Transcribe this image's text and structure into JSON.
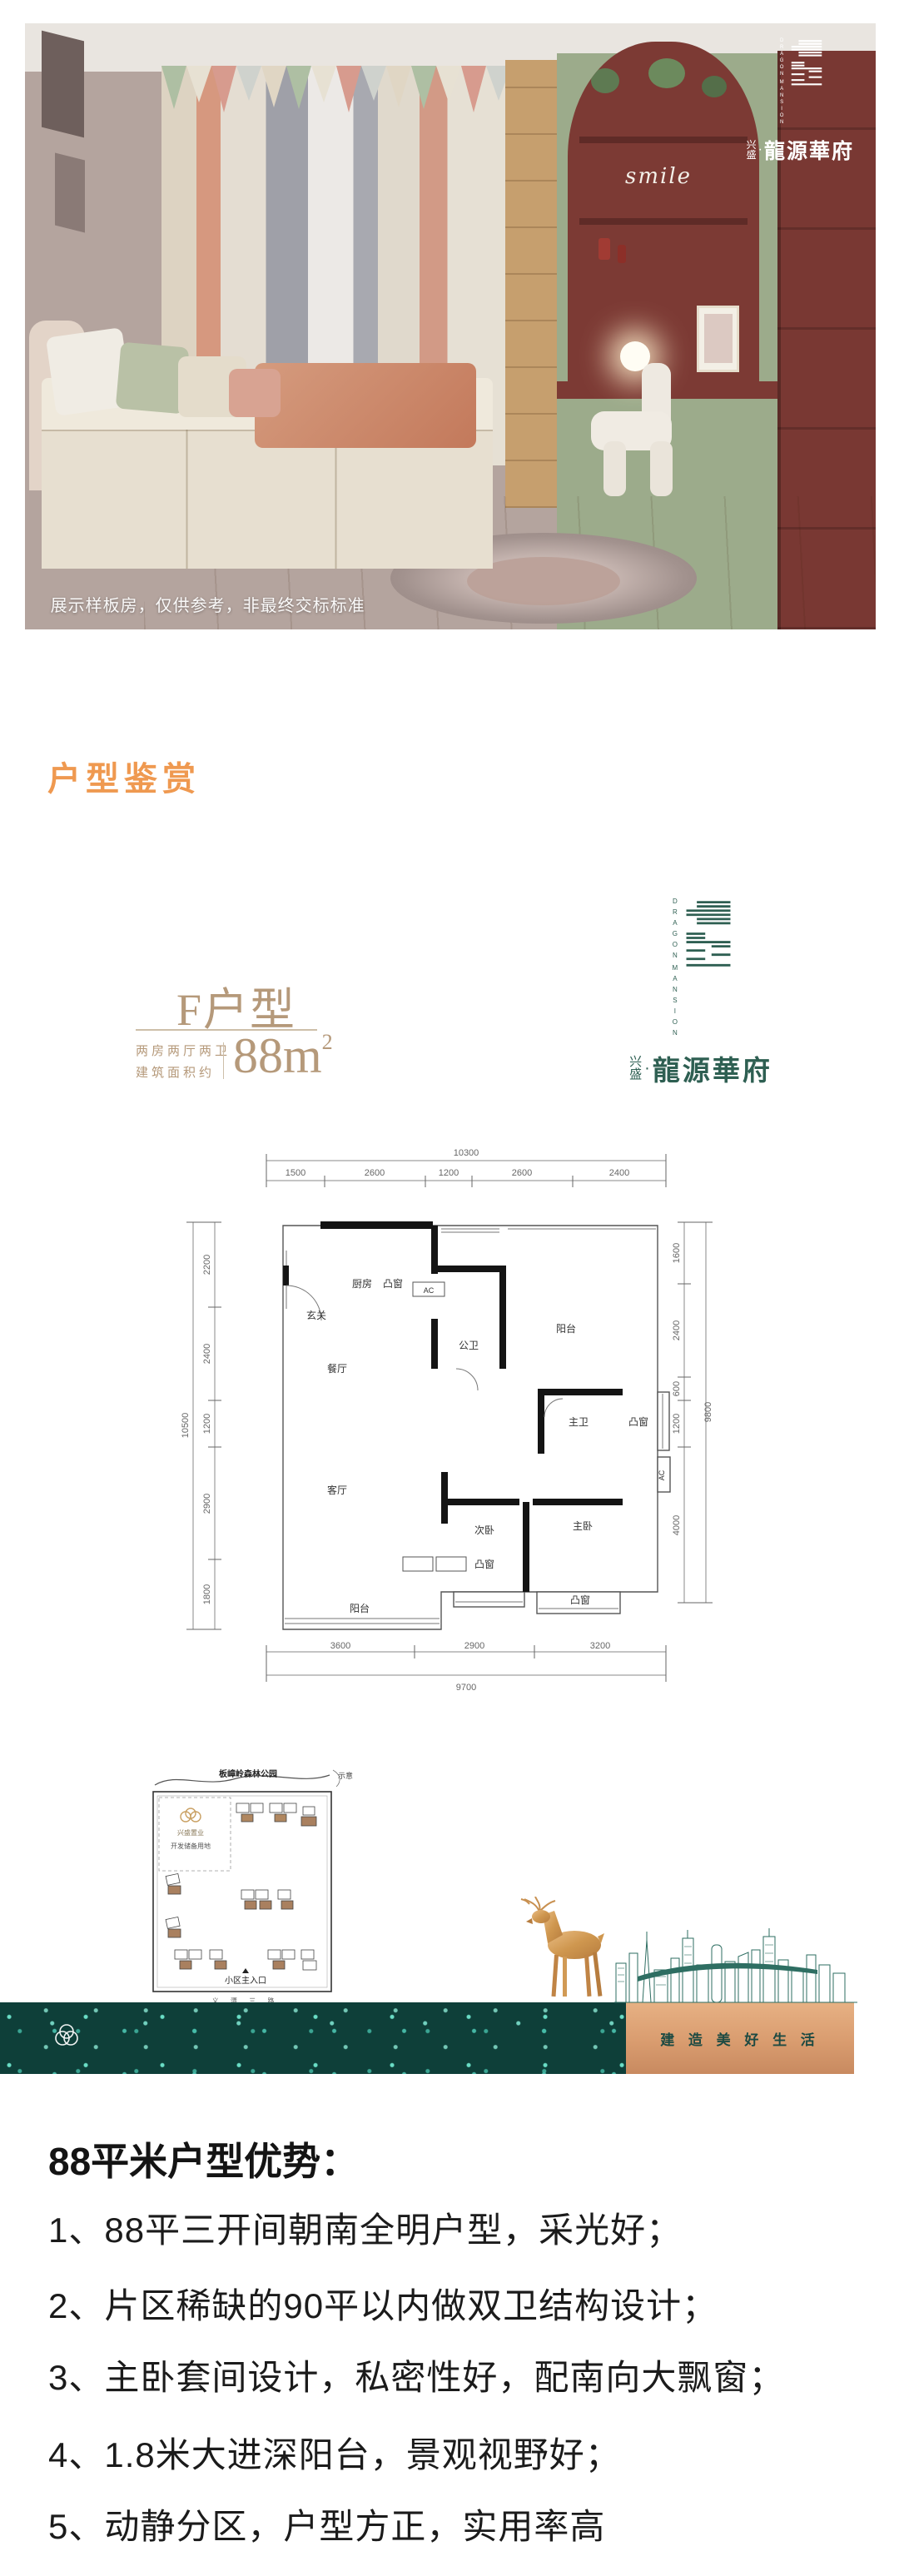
{
  "hero": {
    "watermark": "展示样板房，仅供参考，非最终交标标准",
    "shelf_text": "smile"
  },
  "brand": {
    "en_word1": "DRAGON",
    "en_word2": "MANSION",
    "prefix_char1": "兴",
    "prefix_char2": "盛",
    "dot": "·",
    "name": "龍源華府"
  },
  "section": {
    "title": "户型鉴赏"
  },
  "plan_header": {
    "type_name": "F户型",
    "spec_line1": "两房两厅两卫",
    "spec_line2": "建筑面积约",
    "area_value": "88m",
    "area_sup": "2"
  },
  "floorplan": {
    "dims_top": {
      "total": "10300",
      "segments": [
        "1500",
        "2600",
        "1200",
        "2600",
        "2400"
      ]
    },
    "dims_bottom": {
      "total": "9700",
      "segments": [
        "3600",
        "2900",
        "3200"
      ]
    },
    "dims_left": {
      "total": "10500",
      "segments": [
        "2200",
        "2400",
        "1200",
        "2900",
        "1800"
      ]
    },
    "dims_right": {
      "total": "9800",
      "segments": [
        "1600",
        "2400",
        "600",
        "1200",
        "4000"
      ]
    },
    "rooms": {
      "entry": "玄关",
      "kitchen": "厨房",
      "dining": "餐厅",
      "public_bath": "公卫",
      "balcony_top": "阳台",
      "master_bath": "主卫",
      "living": "客厅",
      "bedroom2": "次卧",
      "master_bedroom": "主卧",
      "balcony_bottom": "阳台"
    },
    "labels": {
      "bay_window": "凸窗",
      "ac": "AC"
    }
  },
  "siteplan": {
    "park_label": "板嶂岭森林公园",
    "schematic_label": "示意",
    "brand_label": "兴盛置业",
    "reserve_label": "开发储备用地",
    "entrance_label": "小区主入口",
    "road_label": "义 潭 三 路"
  },
  "banner": {
    "slogan": "建 造 美 好 生 活"
  },
  "advantages": {
    "heading": "88平米户型优势：",
    "items": [
      "1、88平三开间朝南全明户型，采光好；",
      "2、片区稀缺的90平以内做双卫结构设计；",
      "3、主卧套间设计，私密性好，配南向大飘窗；",
      "4、1.8米大进深阳台，景观视野好；",
      "5、动静分区，户型方正，实用率高"
    ]
  },
  "colors": {
    "accent_orange": "#EF9950",
    "gold": "#B5997A",
    "teal": "#2E5F52",
    "maroon": "#7C3A34",
    "copper": "#D89A6E",
    "dark_teal": "#0E3F39"
  }
}
